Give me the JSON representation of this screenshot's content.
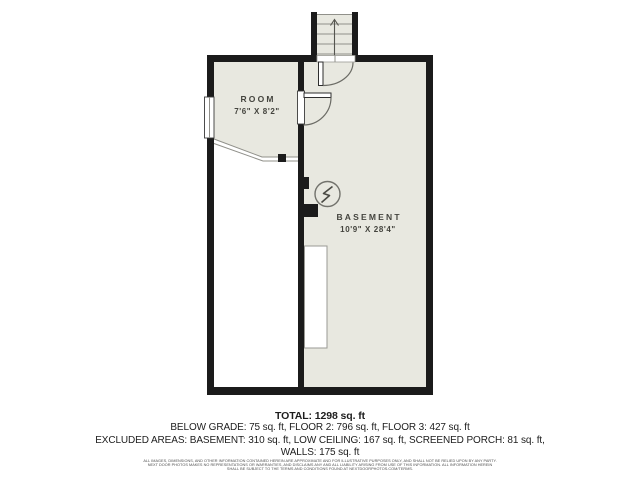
{
  "colors": {
    "floor": "#e8e8e0",
    "wall": "#1b1b1b",
    "line": "#90908a",
    "detail": "#55554f",
    "door": "#6b6b65",
    "label_text": "#44443e",
    "summary_text": "#1d1d1d",
    "disclaimer_text": "#4d4d4d"
  },
  "floorplan": {
    "rooms": [
      {
        "name": "ROOM",
        "dimensions": "7'6\" X 8'2\""
      },
      {
        "name": "BASEMENT",
        "dimensions": "10'9\" X 28'4\""
      }
    ],
    "icons": [
      "stairs-up-arrow-icon",
      "electrical-panel-icon",
      "window",
      "door-swing-arc"
    ]
  },
  "summary": {
    "total": "TOTAL: 1298 sq. ft",
    "below_grade_line": "BELOW GRADE: 75 sq. ft, FLOOR 2: 796 sq. ft, FLOOR 3: 427 sq. ft",
    "excluded_line": "EXCLUDED AREAS: BASEMENT: 310 sq. ft, LOW CEILING: 167 sq. ft, SCREENED PORCH: 81 sq. ft,",
    "walls_line": "WALLS: 175 sq. ft"
  },
  "disclaimer": {
    "line1": "ALL IMAGES, DIMENSIONS, AND OTHER INFORMATION CONTAINED HEREIN ARE APPROXIMATE AND FOR ILLUSTRATIVE PURPOSES ONLY, AND SHALL NOT BE RELIED UPON BY ANY PARTY.",
    "line2": "NEXT DOOR PHOTOS MAKES NO REPRESENTATIONS OR WARRANTIES, AND DISCLAIMS ANY AND ALL LIABILITY ARISING FROM USE OF THIS INFORMATION. ALL INFORMATION HEREIN",
    "line3": "SHALL BE SUBJECT TO THE TERMS AND CONDITIONS FOUND AT NEXTDOORPHOTOS.COM/TERMS."
  }
}
